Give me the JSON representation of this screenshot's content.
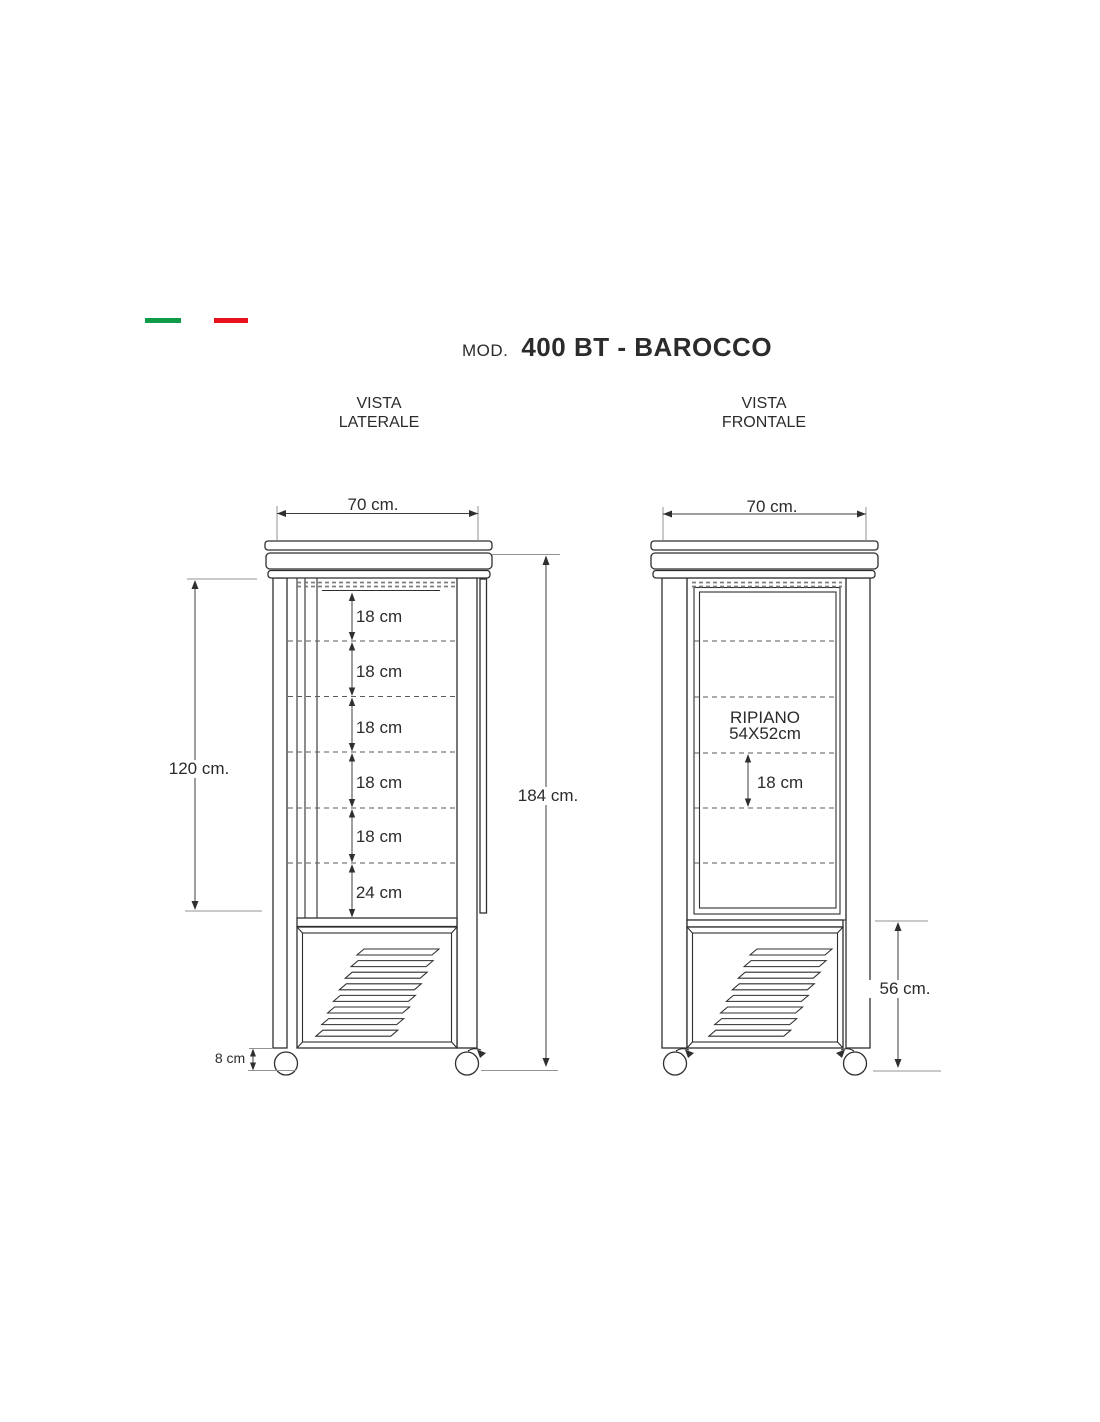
{
  "branding": {
    "flag_green_color": "#0e9c49",
    "flag_red_color": "#e8121c"
  },
  "header": {
    "model_prefix": "MOD.",
    "model_name": "400 BT - BAROCCO"
  },
  "side_view": {
    "title_line1": "VISTA",
    "title_line2": "LATERALE",
    "dim_top_width": "70 cm.",
    "dim_display_height": "120 cm.",
    "dim_total_height": "184 cm.",
    "shelf_gaps": [
      "18 cm",
      "18 cm",
      "18 cm",
      "18 cm",
      "18 cm"
    ],
    "dim_bottom_shelf": "24 cm",
    "dim_wheel_height": "8 cm"
  },
  "front_view": {
    "title_line1": "VISTA",
    "title_line2": "FRONTALE",
    "dim_top_width": "70 cm.",
    "shelf_label_line1": "RIPIANO",
    "shelf_label_line2": "54X52cm",
    "dim_shelf_gap": "18 cm",
    "dim_base_height": "56 cm."
  }
}
